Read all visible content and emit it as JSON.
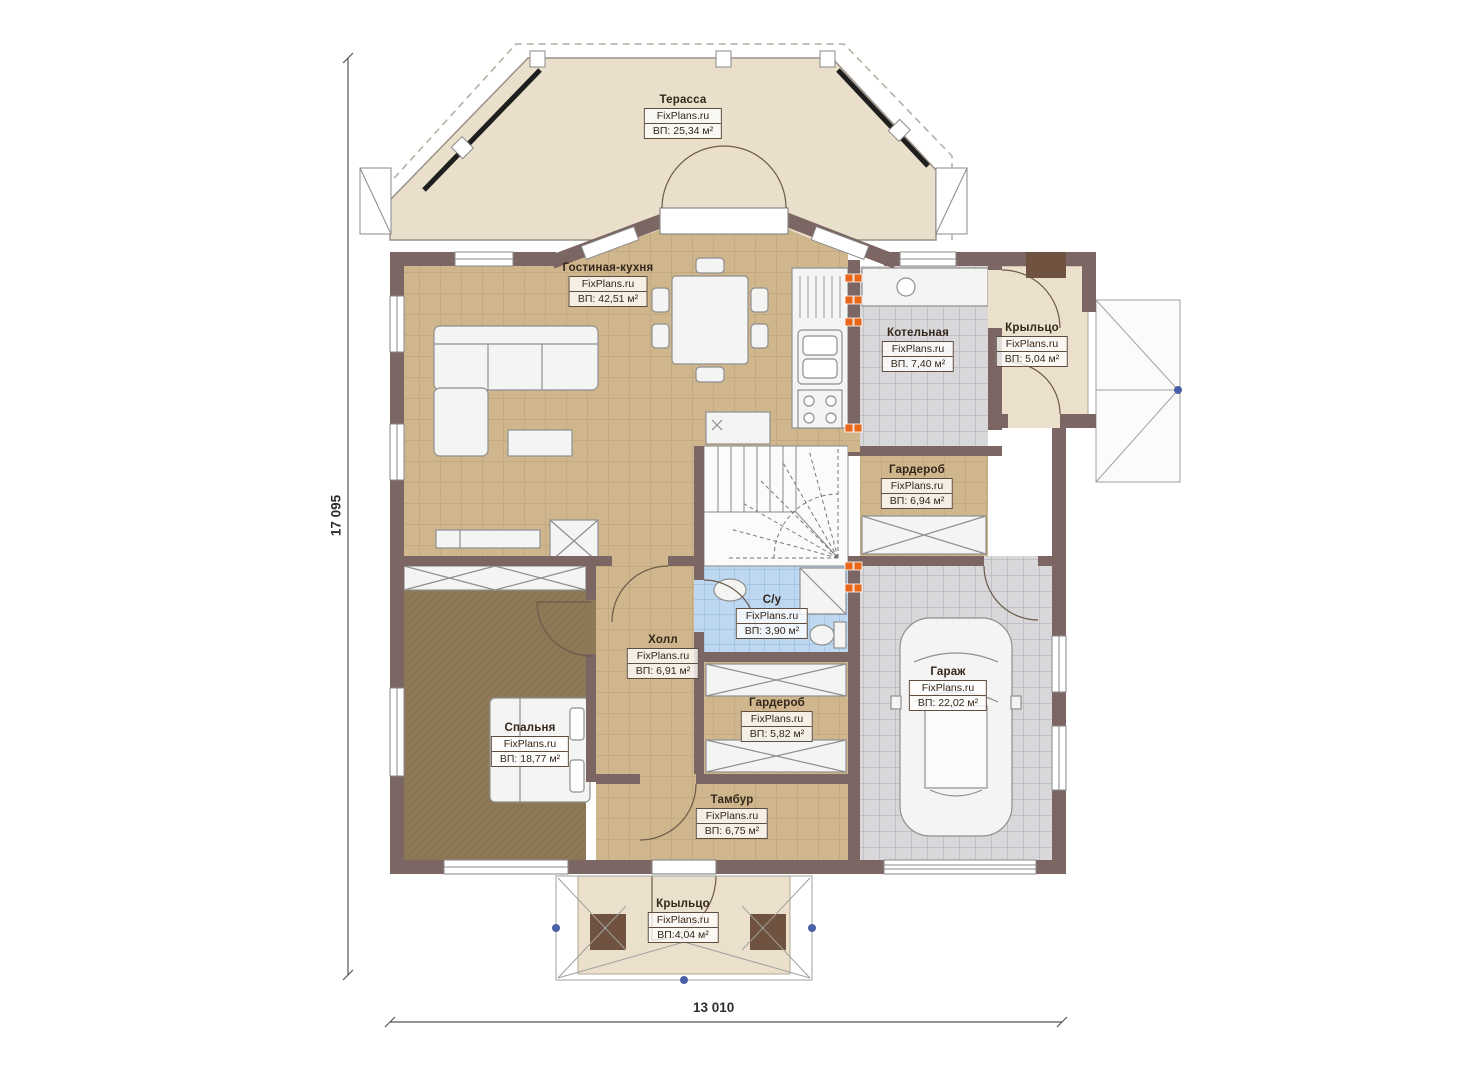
{
  "plan": {
    "brand": "FixPlans.ru",
    "rooms": [
      {
        "id": "terrace",
        "name": "Терасса",
        "area": "ВП: 25,34 м²"
      },
      {
        "id": "living-kitchen",
        "name": "Гостиная-кухня",
        "area": "ВП: 42,51 м²"
      },
      {
        "id": "boiler",
        "name": "Котельная",
        "area": "ВП. 7,40 м²"
      },
      {
        "id": "porch-right",
        "name": "Крыльцо",
        "area": "ВП: 5,04 м²"
      },
      {
        "id": "wardrobe-upper",
        "name": "Гардероб",
        "area": "ВП: 6,94 м²"
      },
      {
        "id": "bathroom",
        "name": "С/у",
        "area": "ВП: 3,90 м²"
      },
      {
        "id": "hall",
        "name": "Холл",
        "area": "ВП: 6,91 м²"
      },
      {
        "id": "wardrobe-lower",
        "name": "Гардероб",
        "area": "ВП: 5,82 м²"
      },
      {
        "id": "bedroom",
        "name": "Спальня",
        "area": "ВП: 18,77 м²"
      },
      {
        "id": "tambour",
        "name": "Тамбур",
        "area": "ВП: 6,75 м²"
      },
      {
        "id": "garage",
        "name": "Гараж",
        "area": "ВП: 22,02 м²"
      },
      {
        "id": "porch-bottom",
        "name": "Крыльцо",
        "area": "ВП:4,04 м²"
      }
    ],
    "dimensions": {
      "height": "17 095",
      "width": "13 010"
    },
    "colors": {
      "wall": "#7b6663",
      "wall_column": "#6f523f",
      "terrace_floor": "#e9dfca",
      "tile_tan": "#cfb68d",
      "tile_gray": "#d8d8da",
      "tile_blue": "#bdd8f0",
      "carpet_brown": "#8e7957",
      "radiator_orange": "#e8671b",
      "canopy_dot_blue": "#4a5fa5"
    }
  }
}
